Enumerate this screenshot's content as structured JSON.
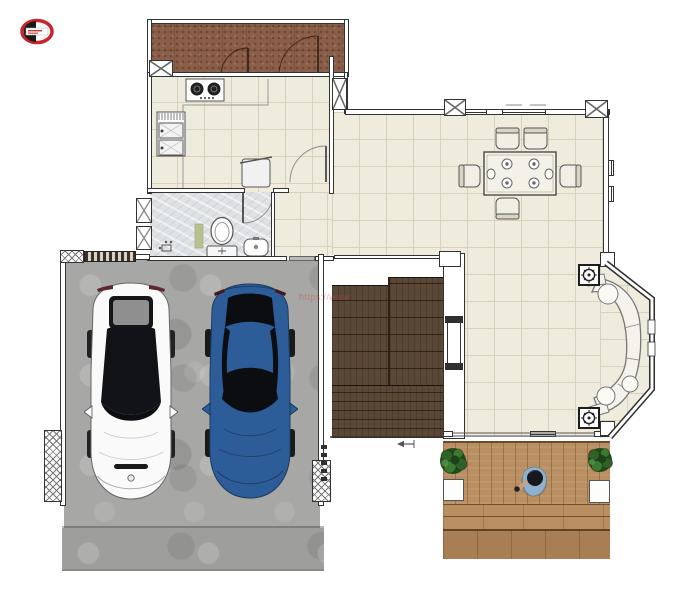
{
  "watermark": {
    "text": "https://www"
  },
  "logo": {
    "label": "site-logo"
  },
  "colors": {
    "porch": "#8a5e49",
    "floor": "#efebdd",
    "grid": "#d8d2bc",
    "marble": "#dfe2e5",
    "concrete": "#a7a7a5",
    "drive": "#9e9e9c",
    "stair": "#5b4736",
    "deck": "#b98e60",
    "deckd": "#a87f55",
    "wall": "#333333",
    "carw": "#fafafa",
    "carb": "#2d5d99",
    "glass": "#121318",
    "plant": "#336227",
    "shirt": "#8fb0cf",
    "red": "#c8242b"
  },
  "scene": {
    "type": "residential-floor-plan-top-view",
    "rooms": [
      "porch",
      "kitchen",
      "bathroom",
      "hallway",
      "dining-living-room",
      "staircase",
      "garage",
      "deck"
    ],
    "objects": [
      "stove",
      "kitchen-sink",
      "trash-bin",
      "toilet",
      "bathroom-sink",
      "bath-mat",
      "dining-table",
      "dining-chairs-x6",
      "curved-sofa",
      "ceiling-fixture-x2",
      "fireplace",
      "white-car",
      "blue-car",
      "deck-plant-x2",
      "person",
      "door-arcs",
      "bay-window"
    ]
  }
}
